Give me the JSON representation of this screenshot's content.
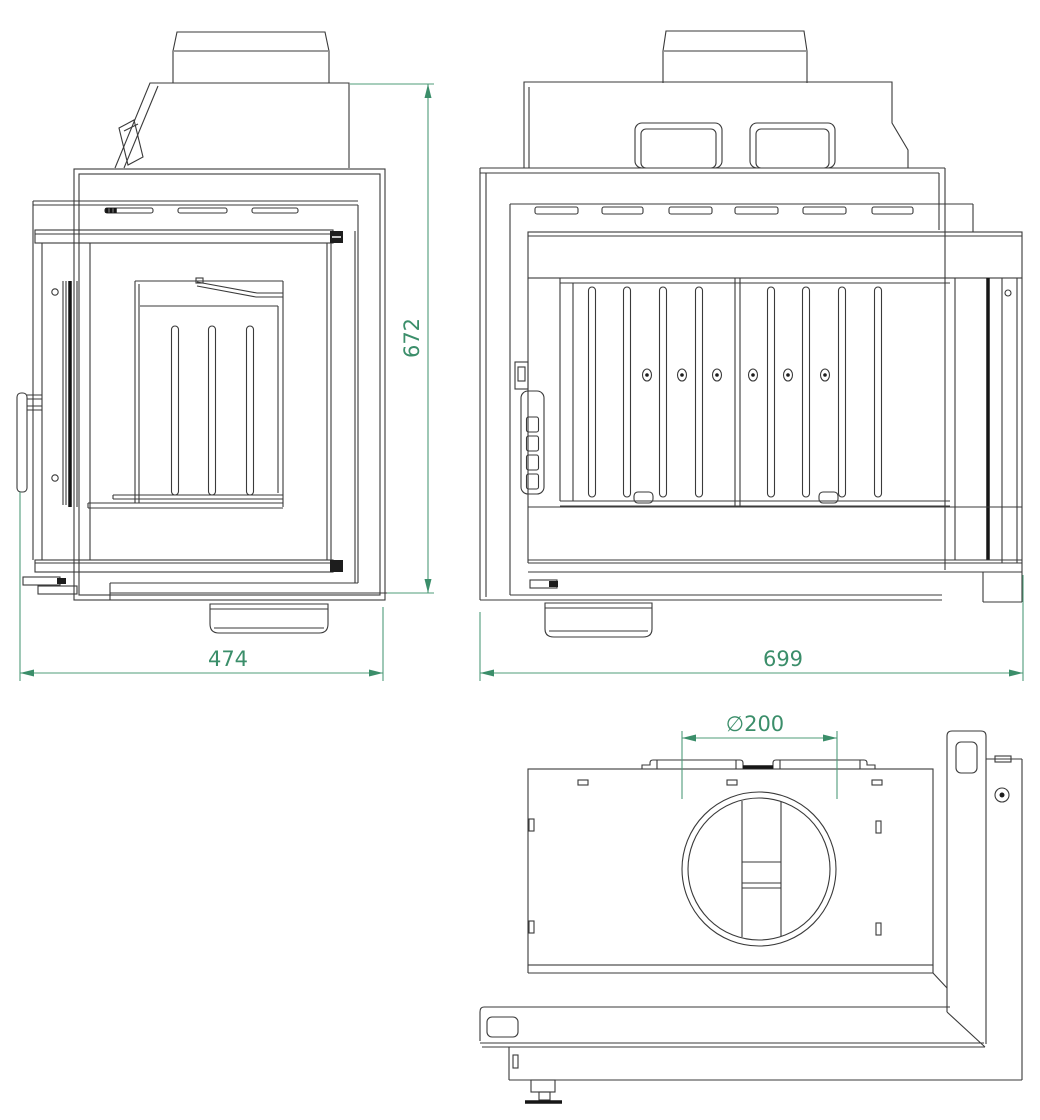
{
  "drawing": {
    "dimensions": {
      "height": "672",
      "depth": "474",
      "width": "699",
      "flue_diameter": "∅200"
    },
    "colors": {
      "dimension_accent": "#3b8e6a",
      "line": "#3a3a3a",
      "background": "#ffffff"
    }
  }
}
